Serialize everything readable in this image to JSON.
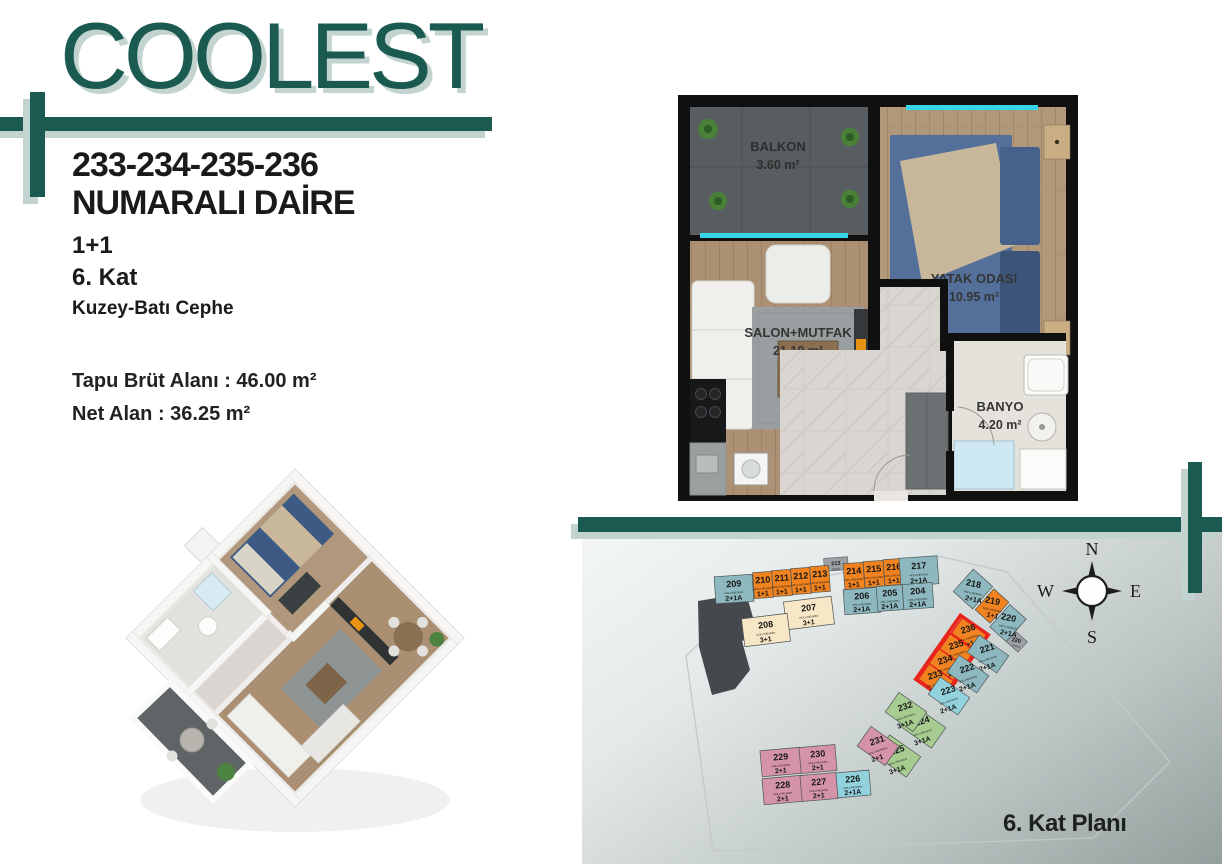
{
  "brand": {
    "logo_text": "COOLEST",
    "accent_color": "#1b5a51",
    "shadow_color": "#c3d4d0"
  },
  "apartment": {
    "title_line1": "233-234-235-236",
    "title_line2": "NUMARALI DAİRE",
    "layout": "1+1",
    "floor": "6. Kat",
    "facade": "Kuzey-Batı Cephe",
    "gross_area": "Tapu Brüt Alanı :  46.00 m²",
    "net_area": "Net Alan :  36.25 m²"
  },
  "floor_plan": {
    "rooms": [
      {
        "name": "BALKON",
        "area": "3.60 m²"
      },
      {
        "name": "YATAK ODASI",
        "area": "10.95 m²"
      },
      {
        "name": "SALON+MUTFAK",
        "area": "21.10 m²"
      },
      {
        "name": "BANYO",
        "area": "4.20 m²"
      }
    ]
  },
  "site_plan": {
    "caption": "6. Kat Planı",
    "unit_sublabel": "NOLU MESKEN",
    "compass": {
      "n": "N",
      "s": "S",
      "e": "E",
      "w": "W"
    },
    "highlight_color": "#e8251c",
    "type_colors": {
      "orange": "#f0831f",
      "teal": "#8db8bf",
      "cyan": "#92d2dd",
      "cream": "#f8e7c7",
      "green": "#a7cc90",
      "pink": "#d593aa",
      "gray": "#9aa0a3"
    },
    "units": [
      {
        "no": "209",
        "t": "2+1A",
        "c": "teal",
        "x": 734,
        "y": 589,
        "w": 38,
        "h": 27,
        "rb": -4,
        "rt": -4
      },
      {
        "no": "210",
        "t": "1+1",
        "c": "orange",
        "x": 763,
        "y": 585,
        "w": 19,
        "h": 26,
        "rb": -4,
        "rt": -4
      },
      {
        "no": "211",
        "t": "1+1",
        "c": "orange",
        "x": 782,
        "y": 583,
        "w": 19,
        "h": 26,
        "rb": -4,
        "rt": -4
      },
      {
        "no": "212",
        "t": "1+1",
        "c": "orange",
        "x": 801,
        "y": 581,
        "w": 19,
        "h": 26,
        "rb": -4,
        "rt": -4
      },
      {
        "no": "213",
        "t": "1+1",
        "c": "orange",
        "x": 820,
        "y": 579,
        "w": 19,
        "h": 26,
        "rb": -4,
        "rt": -4
      },
      {
        "no": "214",
        "t": "1+1",
        "c": "orange",
        "x": 854,
        "y": 576,
        "w": 20,
        "h": 26,
        "rb": -4,
        "rt": -4
      },
      {
        "no": "215",
        "t": "1+1",
        "c": "orange",
        "x": 874,
        "y": 574,
        "w": 20,
        "h": 26,
        "rb": -4,
        "rt": -4
      },
      {
        "no": "216",
        "t": "1+1",
        "c": "orange",
        "x": 894,
        "y": 572,
        "w": 20,
        "h": 26,
        "rb": -4,
        "rt": -4
      },
      {
        "no": "217",
        "t": "2+1A",
        "c": "teal",
        "x": 919,
        "y": 571,
        "w": 38,
        "h": 28,
        "rb": -4,
        "rt": -4
      },
      {
        "no": "206",
        "t": "2+1A",
        "c": "teal",
        "x": 862,
        "y": 601,
        "w": 36,
        "h": 25,
        "rb": -4,
        "rt": -4
      },
      {
        "no": "205",
        "t": "2+1A",
        "c": "teal",
        "x": 890,
        "y": 598,
        "w": 26,
        "h": 25,
        "rb": -4,
        "rt": -4
      },
      {
        "no": "204",
        "t": "2+1A",
        "c": "teal",
        "x": 918,
        "y": 596,
        "w": 30,
        "h": 25,
        "rb": -4,
        "rt": -4
      },
      {
        "no": "207",
        "t": "3+1",
        "c": "cream",
        "x": 809,
        "y": 613,
        "w": 48,
        "h": 28,
        "rb": -7,
        "rt": -7
      },
      {
        "no": "208",
        "t": "3+1",
        "c": "cream",
        "x": 766,
        "y": 630,
        "w": 46,
        "h": 28,
        "rb": -7,
        "rt": -7
      },
      {
        "no": "218",
        "t": "2+1A",
        "c": "teal",
        "x": 973,
        "y": 589,
        "w": 26,
        "h": 30,
        "rb": 42,
        "rt": 12
      },
      {
        "no": "219",
        "t": "1+1",
        "c": "orange",
        "x": 992,
        "y": 606,
        "w": 20,
        "h": 28,
        "rb": 42,
        "rt": 12
      },
      {
        "no": "220",
        "t": "2+1A",
        "c": "teal",
        "x": 1008,
        "y": 623,
        "w": 22,
        "h": 30,
        "rb": 42,
        "rt": 12
      },
      {
        "no": "236",
        "t": "1+1",
        "c": "orange",
        "x": 969,
        "y": 634,
        "w": 19,
        "h": 30,
        "rb": -55,
        "rt": -18,
        "hl": true
      },
      {
        "no": "235",
        "t": "1+1",
        "c": "orange",
        "x": 957,
        "y": 650,
        "w": 19,
        "h": 30,
        "rb": -55,
        "rt": -18,
        "hl": true
      },
      {
        "no": "234",
        "t": "1+1",
        "c": "orange",
        "x": 946,
        "y": 665,
        "w": 19,
        "h": 30,
        "rb": -55,
        "rt": -18,
        "hl": true
      },
      {
        "no": "233",
        "t": "1+1",
        "c": "orange",
        "x": 936,
        "y": 680,
        "w": 19,
        "h": 30,
        "rb": -55,
        "rt": -18,
        "hl": true
      },
      {
        "no": "221",
        "t": "2+1A",
        "c": "teal",
        "x": 988,
        "y": 654,
        "w": 21,
        "h": 36,
        "rb": -55,
        "rt": -18
      },
      {
        "no": "222",
        "t": "2+1A",
        "c": "teal",
        "x": 968,
        "y": 674,
        "w": 21,
        "h": 36,
        "rb": -55,
        "rt": -18
      },
      {
        "no": "223",
        "t": "2+1A",
        "c": "cyan",
        "x": 949,
        "y": 696,
        "w": 21,
        "h": 36,
        "rb": -55,
        "rt": -18
      },
      {
        "no": "224",
        "t": "3+1A",
        "c": "green",
        "x": 923,
        "y": 727,
        "w": 25,
        "h": 38,
        "rb": -55,
        "rt": -18
      },
      {
        "no": "225",
        "t": "3+1A",
        "c": "green",
        "x": 898,
        "y": 756,
        "w": 25,
        "h": 38,
        "rb": -55,
        "rt": -18
      },
      {
        "no": "232",
        "t": "3+1A",
        "c": "green",
        "x": 906,
        "y": 712,
        "w": 24,
        "h": 34,
        "rb": -55,
        "rt": -18
      },
      {
        "no": "231",
        "t": "2+1",
        "c": "pink",
        "x": 878,
        "y": 746,
        "w": 24,
        "h": 34,
        "rb": -55,
        "rt": -18
      },
      {
        "no": "226",
        "t": "2+1A",
        "c": "cyan",
        "x": 853,
        "y": 784,
        "w": 34,
        "h": 25,
        "rb": -5,
        "rt": -5
      },
      {
        "no": "229",
        "t": "2+1",
        "c": "pink",
        "x": 781,
        "y": 762,
        "w": 40,
        "h": 26,
        "rb": -5,
        "rt": -5
      },
      {
        "no": "230",
        "t": "2+1",
        "c": "pink",
        "x": 818,
        "y": 759,
        "w": 36,
        "h": 26,
        "rb": -5,
        "rt": -5
      },
      {
        "no": "228",
        "t": "2+1",
        "c": "pink",
        "x": 783,
        "y": 790,
        "w": 40,
        "h": 26,
        "rb": -5,
        "rt": -5
      },
      {
        "no": "227",
        "t": "2+1",
        "c": "pink",
        "x": 819,
        "y": 787,
        "w": 36,
        "h": 26,
        "rb": -5,
        "rt": -5
      }
    ],
    "stubs": [
      {
        "label": "213",
        "sub": "TERAS",
        "x": 836,
        "y": 564,
        "w": 24,
        "h": 13,
        "rb": -4,
        "rt": -4
      },
      {
        "label": "220",
        "sub": "TERAS",
        "x": 1016,
        "y": 641,
        "w": 18,
        "h": 14,
        "rb": 42,
        "rt": 12
      }
    ],
    "highlight_group": {
      "x": 952,
      "y": 657,
      "w": 78,
      "h": 34,
      "rb": -55
    }
  }
}
